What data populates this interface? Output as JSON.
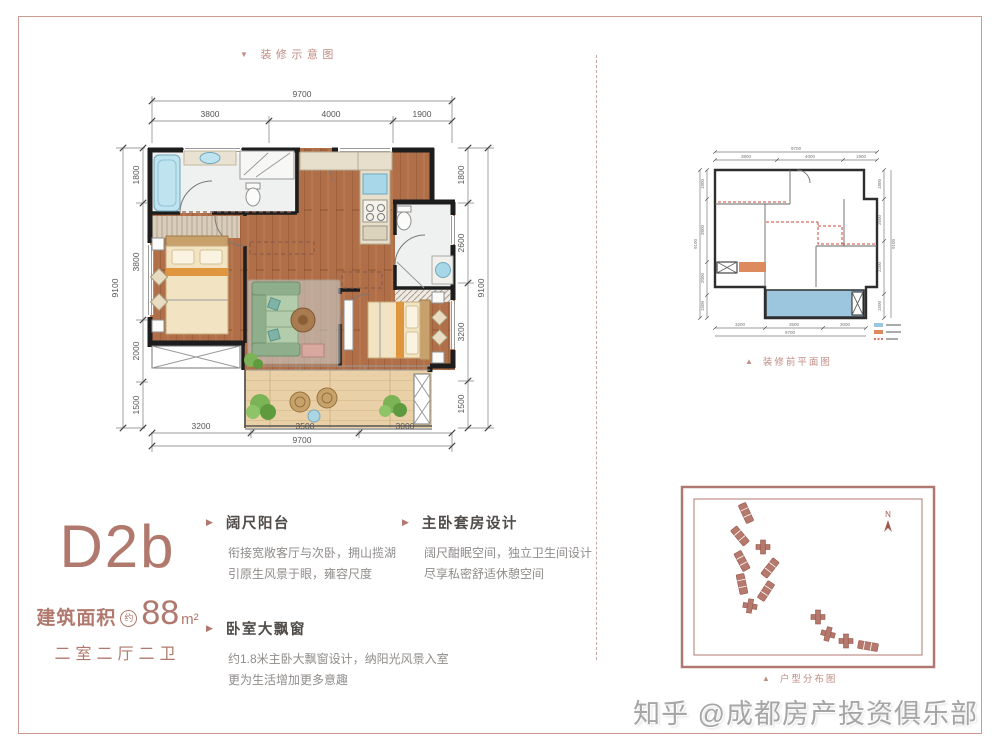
{
  "page": {
    "frame_color": "#cb9a90",
    "accent_color": "#b1796e",
    "watermark": "知乎 @成都房产投资俱乐部"
  },
  "captions": {
    "decorated_plan": {
      "marker": "▼",
      "label": "装修示意图"
    },
    "before_plan": {
      "marker": "▲",
      "label": "装修前平面图"
    },
    "distribution": {
      "marker": "▲",
      "label": "户型分布图"
    }
  },
  "unit": {
    "code": "D2b",
    "area_prefix": "建筑面积",
    "area_circle": "约",
    "area_value": "88",
    "area_unit": "m²",
    "rooms": "二室二厅二卫"
  },
  "features": [
    {
      "title": "阔尺阳台",
      "line1": "衔接宽敞客厅与次卧，拥山揽湖",
      "line2": "引原生风景于眼，雍容尺度"
    },
    {
      "title": "卧室大飘窗",
      "line1": "约1.8米主卧大飘窗设计，纳阳光风景入室",
      "line2": "更为生活增加更多意趣"
    },
    {
      "title": "主卧套房设计",
      "line1": "阔尺酣眠空间，独立卫生间设计",
      "line2": "尽享私密舒适休憩空间"
    }
  ],
  "dims": {
    "top_overall": "9700",
    "top": [
      "3800",
      "4000",
      "1900"
    ],
    "left_overall": "9100",
    "left": [
      "1800",
      "3800",
      "2000",
      "1500"
    ],
    "right_overall": "9100",
    "right": [
      "1800",
      "2600",
      "3200",
      "1500"
    ],
    "bottom_overall": "9700",
    "bottom": [
      "3200",
      "3500",
      "3000"
    ]
  },
  "site": {
    "compass": "N"
  },
  "legend_colors": [
    "#9cc6dd",
    "#dd8a5f",
    "#c84a38"
  ],
  "icons": {
    "bullet": "▶"
  }
}
